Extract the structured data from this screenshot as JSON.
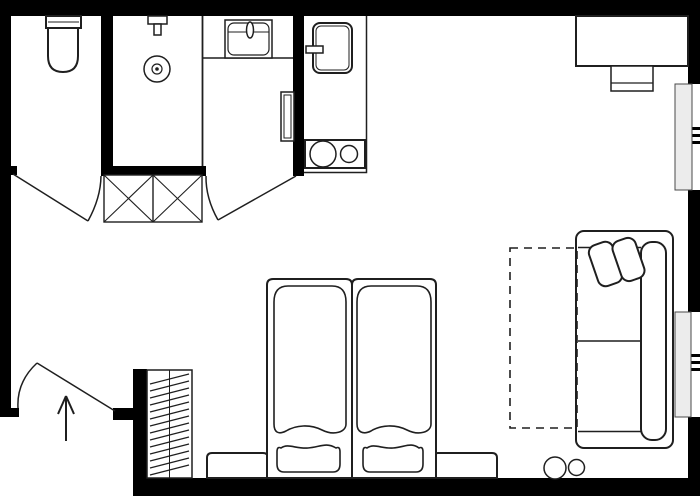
{
  "title": "Studio apartment floor plan",
  "canvas": {
    "width": 700,
    "height": 500
  },
  "colors": {
    "wall": "#000000",
    "line": "#1f1f1f",
    "fill": "#ffffff",
    "window_panel": "#ececec",
    "window_panel_border": "#4a4a4a"
  },
  "symbols": {
    "bathroom": [
      "toilet",
      "shower-head",
      "floor-drain",
      "glass-partition",
      "washbasin",
      "wall-cabinet"
    ],
    "kitchenette": [
      "refrigerator",
      "two-burner-cooktop",
      "counter"
    ],
    "hall": [
      "x-marked-closet",
      "entry-door-swing",
      "entry-direction-arrow",
      "hatched-luggage-rack"
    ],
    "sleeping_area": [
      "twin-bed-left",
      "twin-bed-right",
      "pillow-left",
      "pillow-right",
      "bench-left",
      "bench-right"
    ],
    "living_area": [
      "sofa",
      "sofa-cushion-1",
      "sofa-cushion-2",
      "dashed-extension-area",
      "round-stool-large",
      "round-stool-small",
      "desk",
      "desk-chair"
    ],
    "openings": [
      "toilet-door-arc",
      "bathroom-door-arc",
      "entry-door-arc",
      "window-upper-right",
      "window-lower-right"
    ]
  },
  "counts": {
    "doors": 3,
    "windows": 2,
    "beds": 2,
    "burners": 2,
    "stools": 2,
    "closet_cells": 2
  }
}
